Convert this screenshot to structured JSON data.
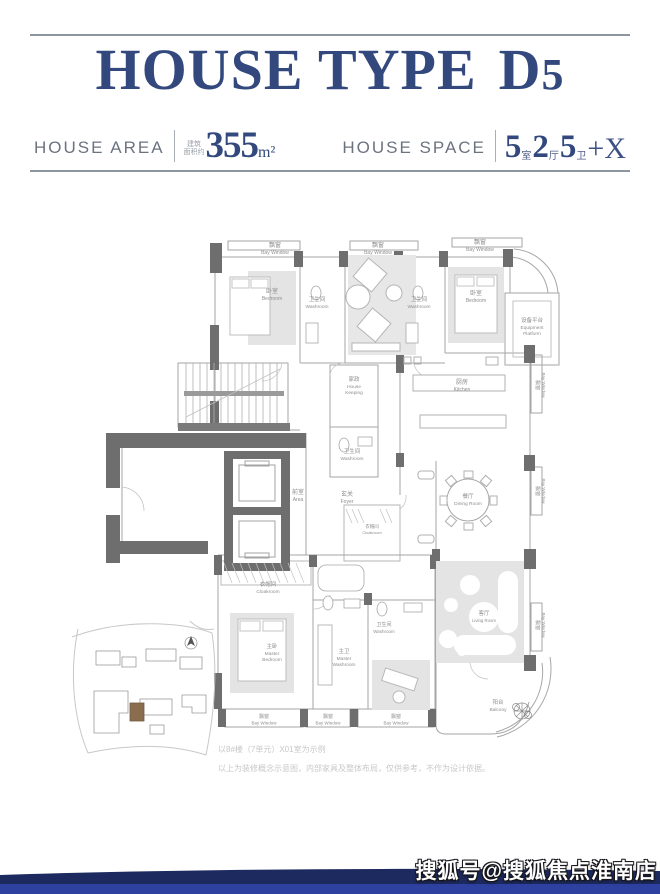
{
  "header": {
    "title_main": "HOUSE TYPE",
    "title_d": "D",
    "title_5": "5",
    "accent_color": "#33497e",
    "area": {
      "label": "HOUSE AREA",
      "prefix_line1": "建筑",
      "prefix_line2": "面积约",
      "value": "355",
      "unit": "m²"
    },
    "space": {
      "label": "HOUSE SPACE",
      "n1": "5",
      "u1": "室",
      "n2": "2",
      "u2": "厅",
      "n3": "5",
      "u3": "卫",
      "suffix": "+X"
    }
  },
  "plan": {
    "rooms": {
      "bay_window": {
        "zh": "飘窗",
        "en": "Bay Window"
      },
      "bedroom": {
        "zh": "卧室",
        "en": "Bedroom"
      },
      "washroom": {
        "zh": "卫生间",
        "en": "Washroom"
      },
      "equipment": {
        "zh": "设备平台",
        "en1": "Equipment",
        "en2": "Platform"
      },
      "kitchen": {
        "zh": "厨房",
        "en": "Kitchen"
      },
      "housekeeping": {
        "zh": "家政",
        "en1": "House",
        "en2": "Keeping"
      },
      "area": {
        "zh": "前室",
        "en": "Area"
      },
      "foyer": {
        "zh": "玄关",
        "en": "Foyer"
      },
      "dining": {
        "zh": "餐厅",
        "en": "Dining Room"
      },
      "cloakroom": {
        "zh": "衣帽间",
        "en": "Cloakroom"
      },
      "master_bedroom": {
        "zh": "主卧",
        "en1": "Master",
        "en2": "Bedroom"
      },
      "master_washroom": {
        "zh": "主卫",
        "en1": "Master",
        "en2": "Washroom"
      },
      "living": {
        "zh": "客厅",
        "en": "Living Room"
      },
      "balcony": {
        "zh": "阳台",
        "en": "Balcony"
      }
    },
    "notes": {
      "line1": "以8#楼（7单元）X01室为示例",
      "line2": "以上为装修概念示意图，内部家具及整体布局，仅供参考，不作为设计依据。"
    }
  },
  "watermark": {
    "text": "搜狐号@搜狐焦点淮南店"
  },
  "footer": {
    "navy": "#1d2a5f",
    "blue": "#2e41a0"
  }
}
